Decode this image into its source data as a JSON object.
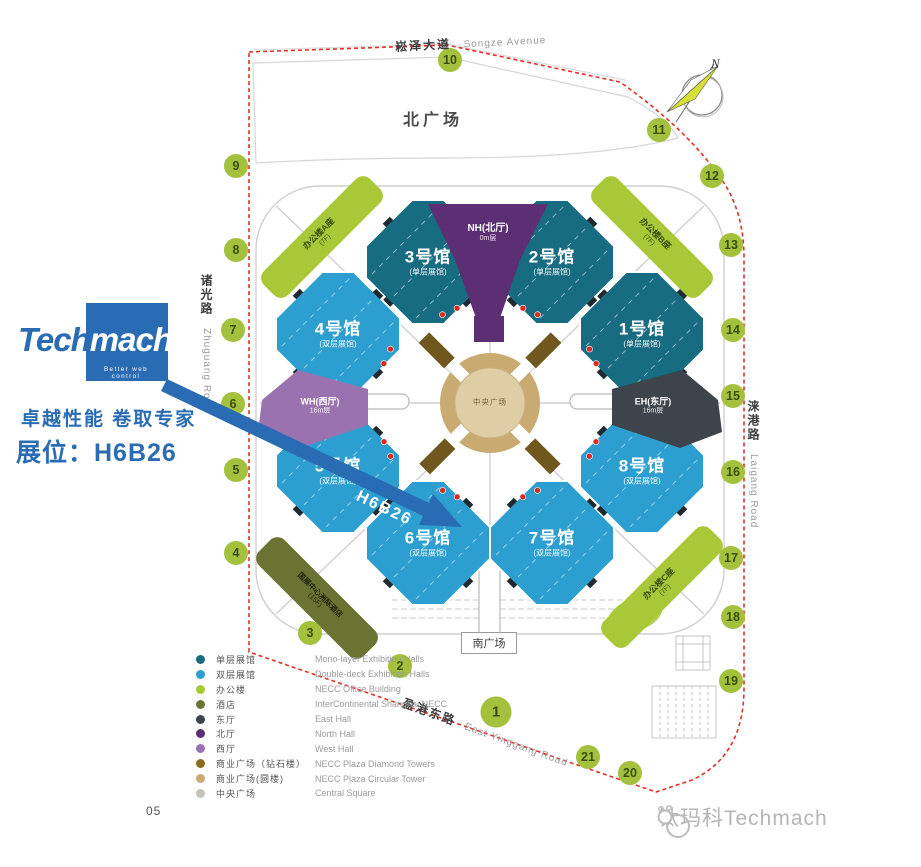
{
  "page_number": "05",
  "branding": {
    "logo_part1": "Tech",
    "logo_part2": "mach",
    "tagline": "Better web control",
    "slogan": "卓越性能  卷取专家",
    "booth_label": "展位：H6B26",
    "arrow_label": "H6B26",
    "watermark": "钛玛科Techmach",
    "brand_blue": "#2a6cb3"
  },
  "map": {
    "north_plaza": "北广场",
    "south_plaza": "南广场",
    "central_square": "中央广场",
    "compass_label": "N",
    "roads": {
      "north_zh": "崧泽大道",
      "north_en": "Songze Avenue",
      "west_zh": "诸光路",
      "west_en": "Zhuguang Road",
      "east_zh": "涞港路",
      "east_en": "Laigang Road",
      "south_zh": "盈港东路",
      "south_en": "East Yinggang Road"
    },
    "halls": [
      {
        "name": "1号馆",
        "sub": "(单层展馆)",
        "type": "mono"
      },
      {
        "name": "2号馆",
        "sub": "(单层展馆)",
        "type": "mono"
      },
      {
        "name": "3号馆",
        "sub": "(单层展馆)",
        "type": "mono"
      },
      {
        "name": "4号馆",
        "sub": "(双层展馆)",
        "type": "double"
      },
      {
        "name": "5号馆",
        "sub": "(双层展馆)",
        "type": "double"
      },
      {
        "name": "6号馆",
        "sub": "(双层展馆)",
        "type": "double"
      },
      {
        "name": "7号馆",
        "sub": "(双层展馆)",
        "type": "double"
      },
      {
        "name": "8号馆",
        "sub": "(双层展馆)",
        "type": "double"
      }
    ],
    "fan_halls": [
      {
        "name": "NH(北厅)",
        "sub": "0m层"
      },
      {
        "name": "WH(西厅)",
        "sub": "16m层"
      },
      {
        "name": "EH(东厅)",
        "sub": "16m层"
      }
    ],
    "offices": [
      {
        "name": "办公楼A座",
        "sub": "(7F)"
      },
      {
        "name": "办公楼B座",
        "sub": "(7F)"
      },
      {
        "name": "办公楼C座",
        "sub": "(7F)"
      }
    ],
    "hotel": {
      "name": "国展中心洲际酒店",
      "sub": "(15F)"
    },
    "gates": [
      "1",
      "2",
      "3",
      "4",
      "5",
      "6",
      "7",
      "8",
      "9",
      "10",
      "11",
      "12",
      "13",
      "14",
      "15",
      "16",
      "17",
      "18",
      "19",
      "20",
      "21"
    ]
  },
  "legend": {
    "items": [
      {
        "zh": "单层展馆",
        "en": "Mono-layer Exhibition Halls",
        "color": "#186c82"
      },
      {
        "zh": "双层展馆",
        "en": "Double-deck Exhibition Halls",
        "color": "#2c9fd0"
      },
      {
        "zh": "办公楼",
        "en": "NECC Office Building",
        "color": "#a9c838"
      },
      {
        "zh": "酒店",
        "en": "InterContinental Shanghai NECC",
        "color": "#6b7332"
      },
      {
        "zh": "东厅",
        "en": "East Hall",
        "color": "#3e444c"
      },
      {
        "zh": "北厅",
        "en": "North Hall",
        "color": "#5c2e73"
      },
      {
        "zh": "西厅",
        "en": "West Hall",
        "color": "#9b72b0"
      },
      {
        "zh": "商业广场（钻石楼）",
        "en": "NECC Plaza Diamond Towers",
        "color": "#8a6d1f"
      },
      {
        "zh": "商业广场(圆楼)",
        "en": "NECC Plaza Circular Tower",
        "color": "#c9aa71"
      },
      {
        "zh": "中央广场",
        "en": "Central Square",
        "color": "#c5c2ba"
      }
    ]
  }
}
